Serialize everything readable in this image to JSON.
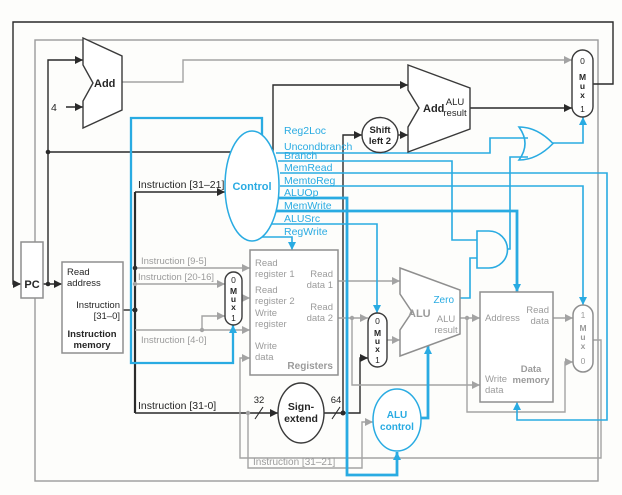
{
  "colors": {
    "accent_blue": "#29abe2",
    "wire_gray": "#a3a3a3",
    "wire_black": "#2a2a2a"
  },
  "diagram": {
    "pc": "PC",
    "four": "4",
    "bits32": "32",
    "bits64": "64",
    "add_top": {
      "name": "Add"
    },
    "add_branch": {
      "name": "Add",
      "result": [
        "ALU",
        "result"
      ]
    },
    "shift": [
      "Shift",
      "left 2"
    ],
    "instruction_memory": {
      "read_address": [
        "Read",
        "address"
      ],
      "instruction": [
        "Instruction",
        "[31–0]"
      ],
      "title": [
        "Instruction",
        "memory"
      ]
    },
    "registers": {
      "read_register_1": [
        "Read",
        "register 1"
      ],
      "read_register_2": [
        "Read",
        "register 2"
      ],
      "write_register": [
        "Write",
        "register"
      ],
      "write_data": [
        "Write",
        "data"
      ],
      "read_data_1": [
        "Read",
        "data 1"
      ],
      "read_data_2": [
        "Read",
        "data 2"
      ],
      "title": "Registers"
    },
    "sign_extend": [
      "Sign-",
      "extend"
    ],
    "alu": {
      "name": "ALU",
      "zero": "Zero",
      "result": [
        "ALU",
        "result"
      ]
    },
    "alu_control": [
      "ALU",
      "control"
    ],
    "control": {
      "name": "Control",
      "signals": [
        "Reg2Loc",
        "Uncondbranch",
        "Branch",
        "MemRead",
        "MemtoReg",
        "ALUOp",
        "MemWrite",
        "ALUSrc",
        "RegWrite"
      ]
    },
    "data_memory": {
      "address": "Address",
      "read_data": [
        "Read",
        "data"
      ],
      "write_data": [
        "Write",
        "data"
      ],
      "title": [
        "Data",
        "memory"
      ]
    },
    "muxes": {
      "pcsrc": [
        "0",
        "M",
        "u",
        "x",
        "1"
      ],
      "reg2loc": [
        "0",
        "M",
        "u",
        "x",
        "1"
      ],
      "alusrc": [
        "0",
        "M",
        "u",
        "x",
        "1"
      ],
      "memtoreg": [
        "1",
        "M",
        "u",
        "x",
        "0"
      ]
    },
    "wire_labels": {
      "instr_31_21_top": "Instruction [31–21]",
      "instr_9_5": "Instruction [9-5]",
      "instr_20_16": "Instruction [20-16]",
      "instr_4_0": "Instruction [4-0]",
      "instr_31_0": "Instruction [31-0]",
      "instr_31_21_bottom": "Instruction [31–21]"
    }
  }
}
